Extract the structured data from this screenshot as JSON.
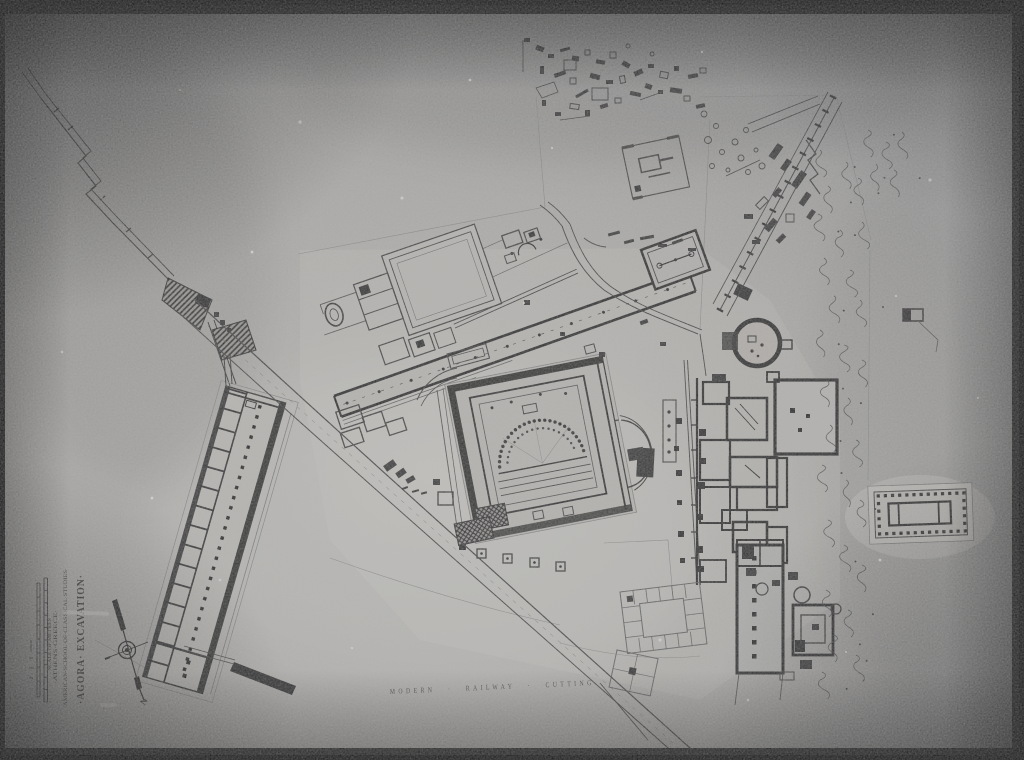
{
  "title_block": {
    "title": "·AGORA· EXCAVATION·",
    "institution": "·AMERICAN·SCHOOL·OF·CLASSICAL·STUDIES·",
    "location": "·ATHENS·GREECE·",
    "scale_caption": "SCALE OF METRES"
  },
  "compass": {
    "north_label": "N"
  },
  "annotations": {
    "railway_label": "MODERN · RAILWAY · CUTTING"
  },
  "palette": {
    "paper": "#a09e9a",
    "ink": "#222222",
    "heavy_wall": "#1c1c1c",
    "light_fill": "#b3b1ad",
    "frame": "#060606",
    "highlight": "#d8d6d2"
  }
}
